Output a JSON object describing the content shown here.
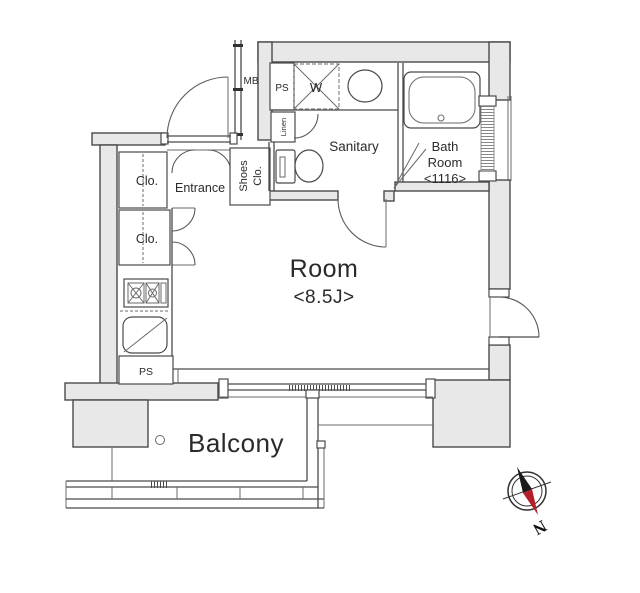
{
  "floorplan": {
    "labels": {
      "mb": "MB",
      "ps_utility": "PS",
      "washer": "W",
      "linen": "Linen",
      "sanitary": "Sanitary",
      "bath_line1": "Bath",
      "bath_line2": "Room",
      "bath_size": "<1116>",
      "closet_upper": "Clo.",
      "closet_lower": "Clo.",
      "entrance": "Entrance",
      "shoes_line1": "Shoes",
      "shoes_line2": "Clo.",
      "room": "Room",
      "room_size": "<8.5J>",
      "ps_kitchen": "PS",
      "balcony": "Balcony",
      "north": "N"
    },
    "colors": {
      "wall_fill": "#e8e8e8",
      "line": "#4a4a4a",
      "compass_north_red": "#b51f2a"
    }
  }
}
